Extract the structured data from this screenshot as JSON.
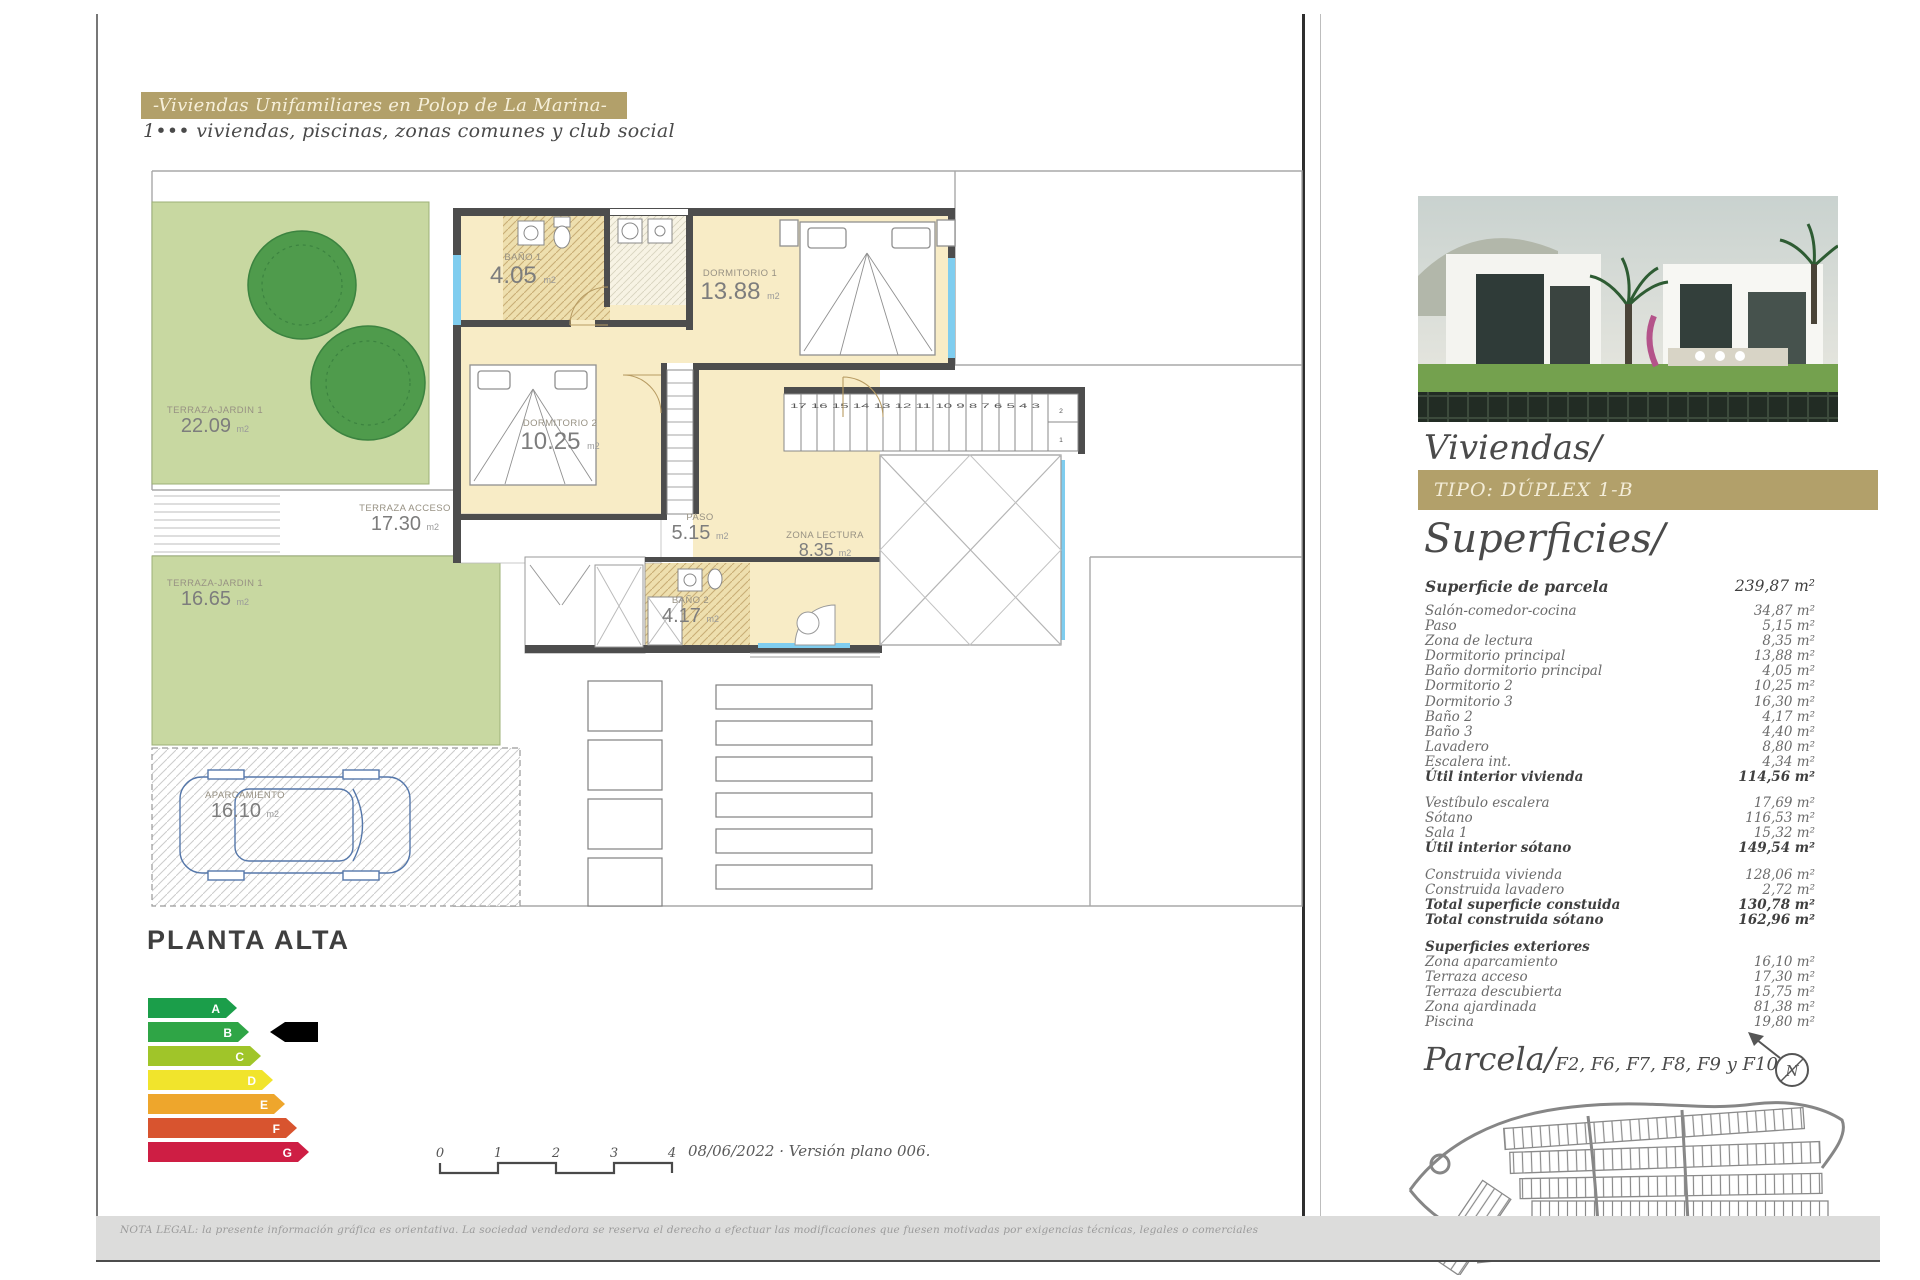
{
  "header": {
    "title": "-Viviendas Unifamiliares en Polop de La Marina-",
    "subtitle": "1••• viviendas, piscinas, zonas comunes y club social"
  },
  "plan": {
    "floor_label": "PLANTA ALTA",
    "rooms": [
      {
        "name": "TERRAZA-JARDIN 1",
        "area": "22.09",
        "unit": "m2"
      },
      {
        "name": "TERRAZA ACCESO",
        "area": "17.30",
        "unit": "m2"
      },
      {
        "name": "TERRAZA-JARDIN 1",
        "area": "16.65",
        "unit": "m2"
      },
      {
        "name": "APARCAMIENTO",
        "area": "16.10",
        "unit": "m2"
      },
      {
        "name": "BAÑO 1",
        "area": "4.05",
        "unit": "m2"
      },
      {
        "name": "DORMITORIO 1",
        "area": "13.88",
        "unit": "m2"
      },
      {
        "name": "DORMITORIO 2",
        "area": "10.25",
        "unit": "m2"
      },
      {
        "name": "PASO",
        "area": "5.15",
        "unit": "m2"
      },
      {
        "name": "ZONA LECTURA",
        "area": "8.35",
        "unit": "m2"
      },
      {
        "name": "BAÑO 2",
        "area": "4.17",
        "unit": "m2"
      }
    ],
    "stair_numbers": "17 16 15 14 13 12 11 10 9 8 7 6 5 4 3",
    "stair_numbers_side": [
      "2",
      "1"
    ],
    "scale_ticks": [
      "0",
      "1",
      "2",
      "3",
      "4"
    ],
    "version_note": "08/06/2022 · Versión plano 006."
  },
  "energy": {
    "indicator": "B",
    "levels": [
      {
        "letter": "A",
        "color": "#1b9e4a",
        "width": 78
      },
      {
        "letter": "B",
        "color": "#2fa546",
        "width": 90
      },
      {
        "letter": "C",
        "color": "#a0c529",
        "width": 102
      },
      {
        "letter": "D",
        "color": "#f1e42c",
        "width": 114
      },
      {
        "letter": "E",
        "color": "#eea62c",
        "width": 126
      },
      {
        "letter": "F",
        "color": "#d8542f",
        "width": 138
      },
      {
        "letter": "G",
        "color": "#ce1e44",
        "width": 150
      }
    ]
  },
  "sidebar": {
    "section_title": "Viviendas/",
    "tipo_label": "TIPO: DÚPLEX 1-B",
    "superficies_title": "Superficies/",
    "parcela_row": {
      "label": "Superficie de parcela",
      "value": "239,87 m²"
    },
    "groups": [
      [
        {
          "label": "Salón-comedor-cocina",
          "value": "34,87 m²"
        },
        {
          "label": "Paso",
          "value": "5,15 m²"
        },
        {
          "label": "Zona de lectura",
          "value": "8,35 m²"
        },
        {
          "label": "Dormitorio principal",
          "value": "13,88 m²"
        },
        {
          "label": "Baño dormitorio principal",
          "value": "4,05 m²"
        },
        {
          "label": "Dormitorio 2",
          "value": "10,25 m²"
        },
        {
          "label": "Dormitorio 3",
          "value": "16,30 m²"
        },
        {
          "label": "Baño 2",
          "value": "4,17 m²"
        },
        {
          "label": "Baño 3",
          "value": "4,40 m²"
        },
        {
          "label": "Lavadero",
          "value": "8,80 m²"
        },
        {
          "label": "Escalera int.",
          "value": "4,34 m²"
        },
        {
          "label": "Útil interior vivienda",
          "value": "114,56 m²",
          "bold": true
        }
      ],
      [
        {
          "label": "Vestíbulo escalera",
          "value": "17,69 m²"
        },
        {
          "label": "Sótano",
          "value": "116,53 m²"
        },
        {
          "label": "Sala 1",
          "value": "15,32 m²"
        },
        {
          "label": "Útil interior sótano",
          "value": "149,54 m²",
          "bold": true
        }
      ],
      [
        {
          "label": "Construida vivienda",
          "value": "128,06 m²"
        },
        {
          "label": "Construida lavadero",
          "value": "2,72 m²"
        },
        {
          "label": "Total superficie constuida",
          "value": "130,78 m²",
          "bold": true
        },
        {
          "label": "Total construida sótano",
          "value": "162,96 m²",
          "bold": true
        }
      ],
      [
        {
          "label": "Superficies exteriores",
          "value": "",
          "bold": true
        },
        {
          "label": "Zona aparcamiento",
          "value": "16,10 m²"
        },
        {
          "label": "Terraza acceso",
          "value": "17,30 m²"
        },
        {
          "label": "Terraza descubierta",
          "value": "15,75 m²"
        },
        {
          "label": "Zona ajardinada",
          "value": "81,38 m²"
        },
        {
          "label": "Piscina",
          "value": "19,80 m²"
        }
      ]
    ],
    "parcela_heading": "Parcela/",
    "parcela_refs": "F2, F6, F7, F8, F9 y F10"
  },
  "footer": {
    "legal": "NOTA LEGAL: la presente información gráfica es orientativa. La sociedad vendedora se reserva el derecho a efectuar las modificaciones que fuesen motivadas por exigencias técnicas, legales o comerciales"
  },
  "colors": {
    "accent_gold": "#b2a06a",
    "room_cream": "#f8ecc6",
    "bath_tan": "#eedfae",
    "garden_green": "#c8d8a1",
    "window_cyan": "#7fcdef",
    "wall_gray": "#4d4d4d",
    "highlight_pink": "#d6246b"
  }
}
